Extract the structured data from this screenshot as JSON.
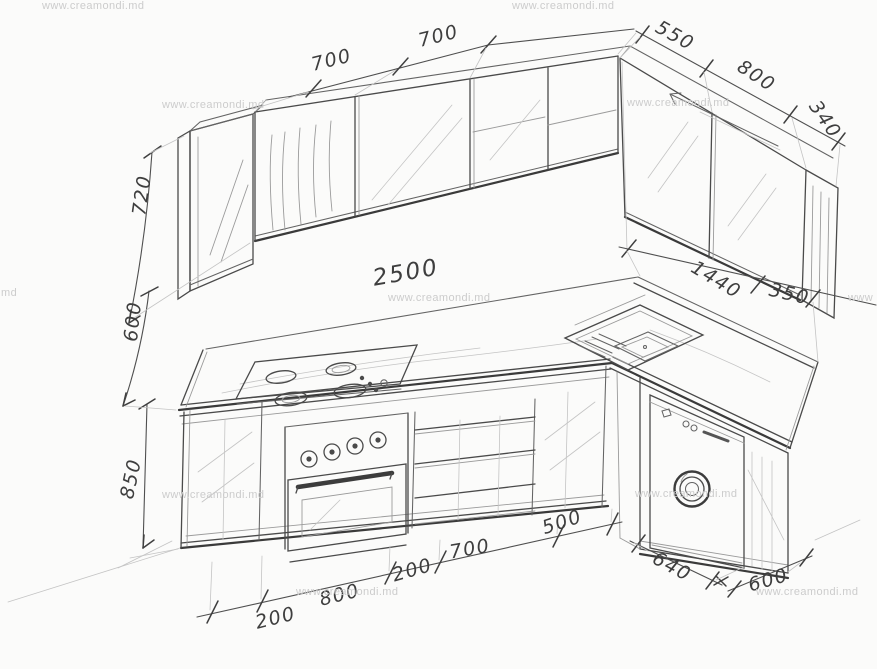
{
  "watermark": {
    "text": "www.creamondi.md",
    "fragment_left": "md",
    "fragment_right": "www"
  },
  "dims": {
    "wall_top_1": "700",
    "wall_top_2": "700",
    "right_top_1": "550",
    "right_top_2": "800",
    "right_top_3": "340",
    "height_upper": "720",
    "height_mid": "600",
    "height_base": "850",
    "counter_length": "2500",
    "right_wall_1": "1440",
    "right_wall_2": "350",
    "bottom_1": "200",
    "bottom_2": "800",
    "bottom_3": "200",
    "bottom_4": "700",
    "bottom_5": "500",
    "right_bottom_1": "640",
    "right_bottom_2": "600"
  },
  "colors": {
    "pencil": "#4a4a4a",
    "pencil_light": "#9b9b9b",
    "paper": "#fbfbfa",
    "watermark": "#cccccc",
    "label_ink": "#3e3e3e"
  }
}
